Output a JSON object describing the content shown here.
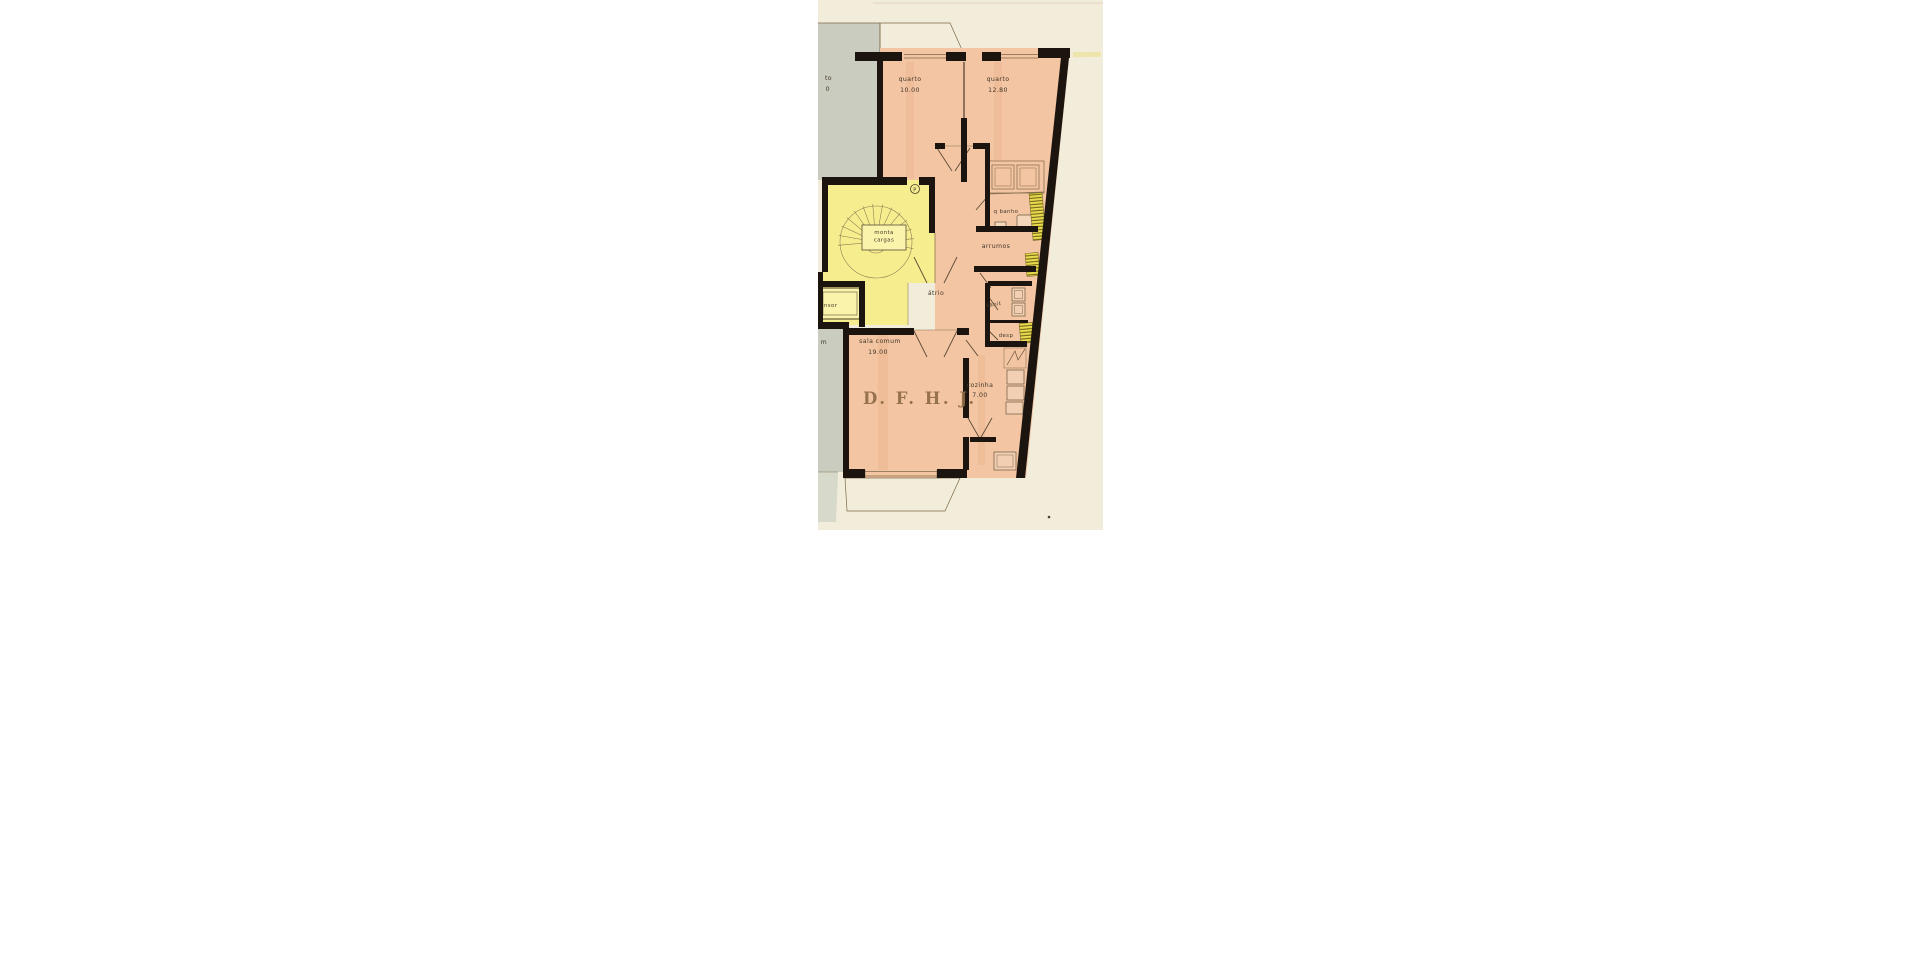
{
  "plan": {
    "colors": {
      "paper": "#f2ecda",
      "room_pink": "#f3c5a3",
      "balcony_pink": "#f2cfb2",
      "adjacent_gray": "#c9ccbe",
      "adjacent_gray_light": "#d7d9cb",
      "stair_yellow": "#f6ee8e",
      "elevator_yellow": "#f9f3ab",
      "hatch_yellow": "#e8dc4e",
      "wall_black": "#1c150f",
      "stamp_brown": "#8d6a46"
    },
    "rooms": {
      "adjacent_quarto": {
        "label_line1": "to",
        "label_line2": "0"
      },
      "adjacent_sala": {
        "label_partial": "m"
      },
      "quarto_1": {
        "label": "quarto",
        "area": "10.00"
      },
      "quarto_2": {
        "label": "quarto",
        "area": "12.80"
      },
      "monta_cargas": {
        "label_line1": "monta",
        "label_line2": "cargas"
      },
      "stair_door": {
        "label": "P"
      },
      "ascensor": {
        "label": "ascensor"
      },
      "atrio": {
        "label": "átrio"
      },
      "banho": {
        "label": "q banho"
      },
      "arrumos": {
        "label": "arrumos"
      },
      "sanit": {
        "label": "sanit"
      },
      "desp": {
        "label": "desp"
      },
      "sala_comum": {
        "label": "sala comum",
        "area": "19.00"
      },
      "cozinha": {
        "label": "cozinha",
        "area": "7.00"
      },
      "stamp": {
        "label": "D. F. H. J."
      }
    }
  }
}
